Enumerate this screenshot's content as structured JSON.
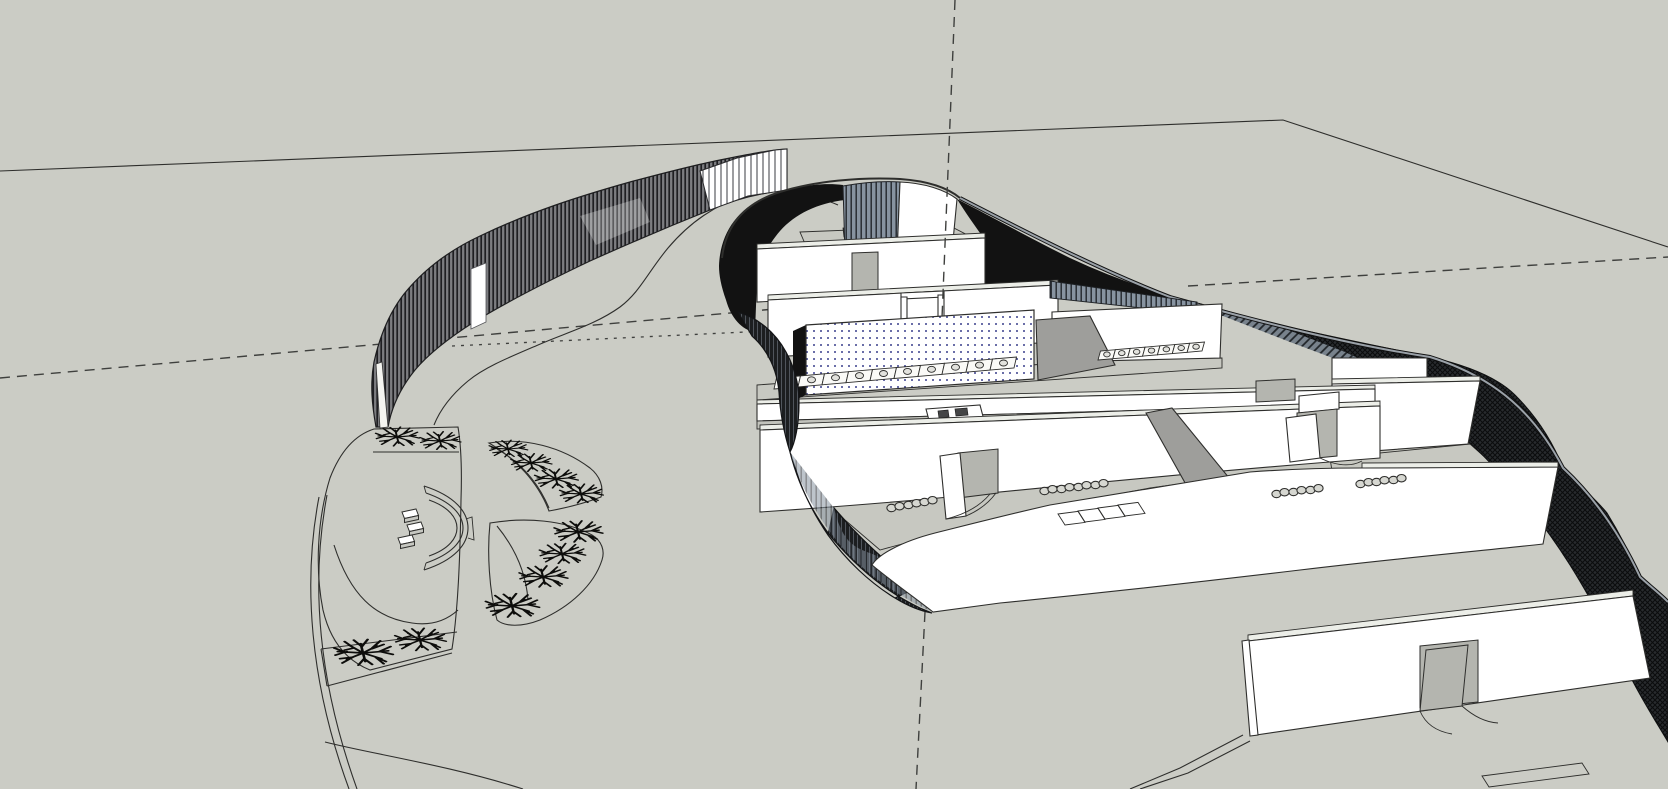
{
  "viewport": {
    "width": 1668,
    "height": 789,
    "description": "Monochrome aerial 3D model view: curved single-storey building with interior partitions, toilet row and classroom furniture; landscaped courtyard with palm-tree plan symbols; curved slatted perimeter fence; dashed drawing axes on a gray ground plane; freestanding wall with open door at lower right."
  },
  "colors": {
    "background": "#cbccc5",
    "line": "#2e2e2c",
    "axis": "#3f403e",
    "white_face": "#ffffff",
    "top_face": "#eceee8",
    "floor": "#c7c8c1",
    "floor_dark": "#c2c3bc",
    "mid_gray": "#9e9e9b",
    "door_gray": "#b4b5af",
    "black_shadow": "#121212",
    "dark_wall_base": "#282b2e",
    "steel_blue": "#8793a0",
    "fence_base": "#7c7d80",
    "dot_blue": "#3a3f8c",
    "rim_gray": "#9aa1a8",
    "tree_black": "#0d0d0b",
    "chair_fill": "#d6d7d1"
  },
  "placements": {
    "trees": [
      [
        397,
        437,
        0.85
      ],
      [
        440,
        441,
        0.8
      ],
      [
        508,
        449,
        0.75
      ],
      [
        531,
        463,
        0.8
      ],
      [
        556,
        479,
        0.85
      ],
      [
        581,
        494,
        0.85
      ],
      [
        578,
        532,
        0.95
      ],
      [
        562,
        554,
        0.9
      ],
      [
        543,
        577,
        0.95
      ],
      [
        512,
        606,
        1.05
      ],
      [
        363,
        653,
        1.15
      ],
      [
        420,
        640,
        1.0
      ]
    ],
    "chairs": [
      [
        887,
        504
      ],
      [
        904,
        501
      ],
      [
        920,
        498
      ],
      [
        1040,
        487
      ],
      [
        1057,
        485
      ],
      [
        1074,
        483
      ],
      [
        1091,
        481
      ],
      [
        1272,
        490
      ],
      [
        1289,
        488
      ],
      [
        1306,
        486
      ],
      [
        1356,
        480
      ],
      [
        1372,
        478
      ],
      [
        1389,
        476
      ]
    ],
    "tables": [
      {
        "x": 1058,
        "y": 514,
        "w": 20
      },
      {
        "x": 1078,
        "y": 511,
        "w": 20
      },
      {
        "x": 1098,
        "y": 508,
        "w": 20
      },
      {
        "x": 1118,
        "y": 505,
        "w": 20
      },
      {
        "x": 1482,
        "y": 776,
        "w": 100
      }
    ],
    "bench_seats": [
      [
        402,
        512
      ],
      [
        407,
        525
      ],
      [
        398,
        538
      ]
    ],
    "stall_rows": [
      {
        "x1": 774,
        "y1": 389,
        "x2": 1014,
        "y2": 368,
        "count": 10,
        "depth": 11
      },
      {
        "x1": 1098,
        "y1": 360,
        "x2": 1202,
        "y2": 351,
        "count": 7,
        "depth": 9
      }
    ]
  }
}
